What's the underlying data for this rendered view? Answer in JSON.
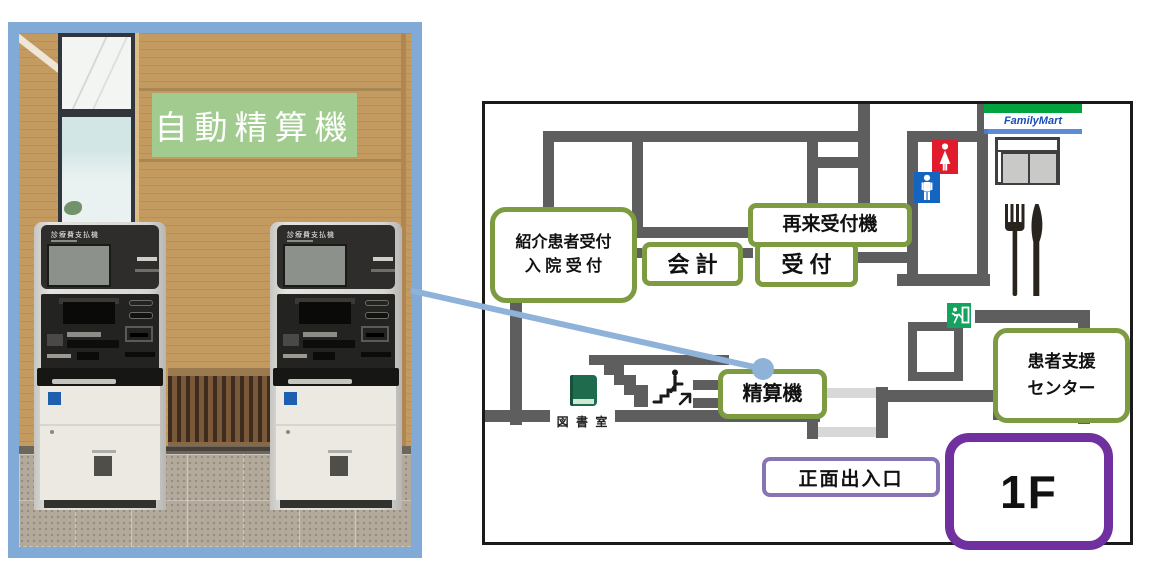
{
  "photo": {
    "sign": "自動精算機",
    "machine_label": "診療費支払機"
  },
  "map": {
    "floor_badge": "1F",
    "familymart": "FamilyMart",
    "boxes": {
      "referral_line1": "紹介患者受付",
      "referral_line2": "入 院 受 付",
      "accounting": "会 計",
      "reception": "受 付",
      "return_checkin_machine": "再来受付機",
      "payment_machine": "精算機",
      "patient_support_line1": "患者支援",
      "patient_support_line2": "センター",
      "main_entrance": "正面出入口"
    },
    "labels": {
      "library": "図 書 室"
    }
  },
  "colors": {
    "photo_frame_blue": "#82aad6",
    "connector_blue": "#8fb2d9",
    "wall_gray": "#5e5e5e",
    "box_green_border": "#7d9b40",
    "entrance_purple": "#8874b4",
    "floor_purple": "#7030a0",
    "familymart_green": "#00a33e",
    "familymart_blue": "#1b4eb3",
    "toilet_female_red": "#e01b2c",
    "toilet_male_blue": "#1565c0",
    "exit_green": "#13a35e",
    "photo_sign_green": "#a2cb90"
  }
}
